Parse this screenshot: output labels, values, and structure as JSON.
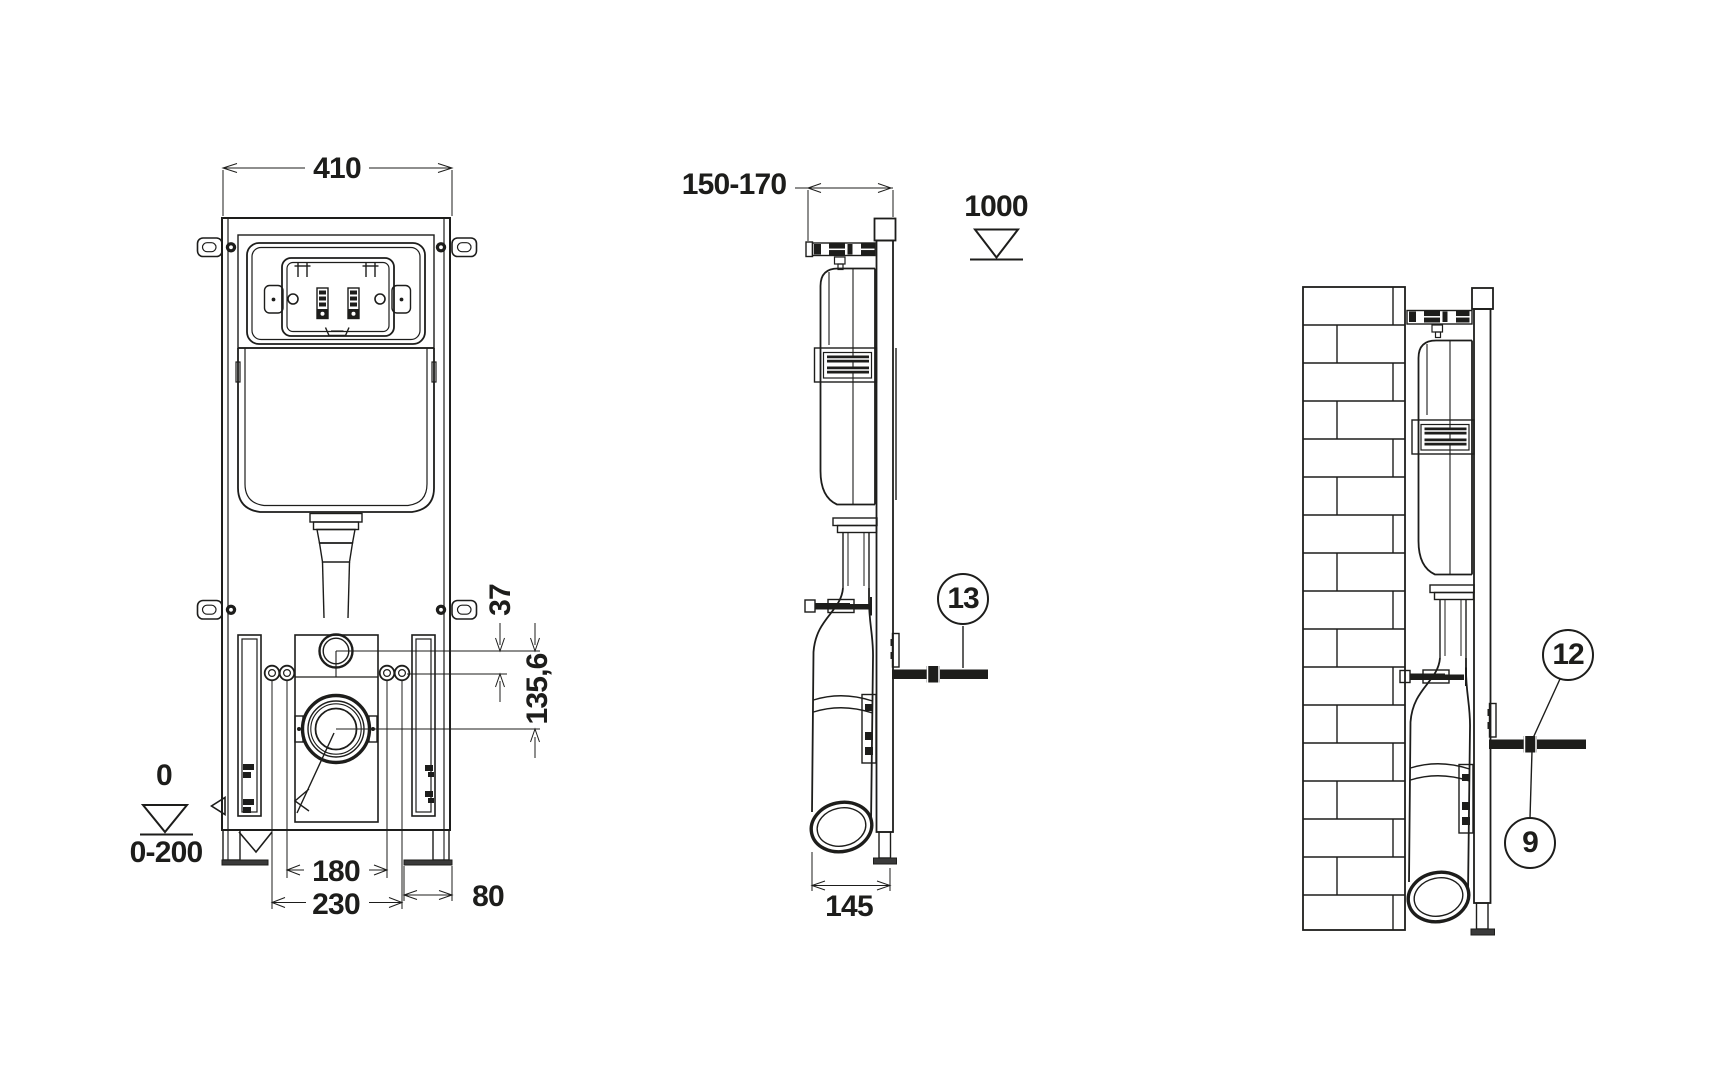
{
  "drawing": {
    "subject": "concealed-wc-cistern-frame-installation",
    "colors": {
      "ink": "#1d1d1b",
      "paper": "#ffffff"
    },
    "front_view": {
      "width": "410",
      "inlet_offset": "37",
      "drain_offset": "135,6",
      "datum_zero": "0",
      "datum_range": "0-200",
      "fixings_inner": "180",
      "fixings_outer": "230",
      "foot_width": "80"
    },
    "side_view": {
      "depth": "150-170",
      "datum_height": "1000",
      "outlet_depth": "145",
      "callout_fixing_rod": "13"
    },
    "installed_view": {
      "callout_nut": "12",
      "callout_rod": "9"
    }
  }
}
